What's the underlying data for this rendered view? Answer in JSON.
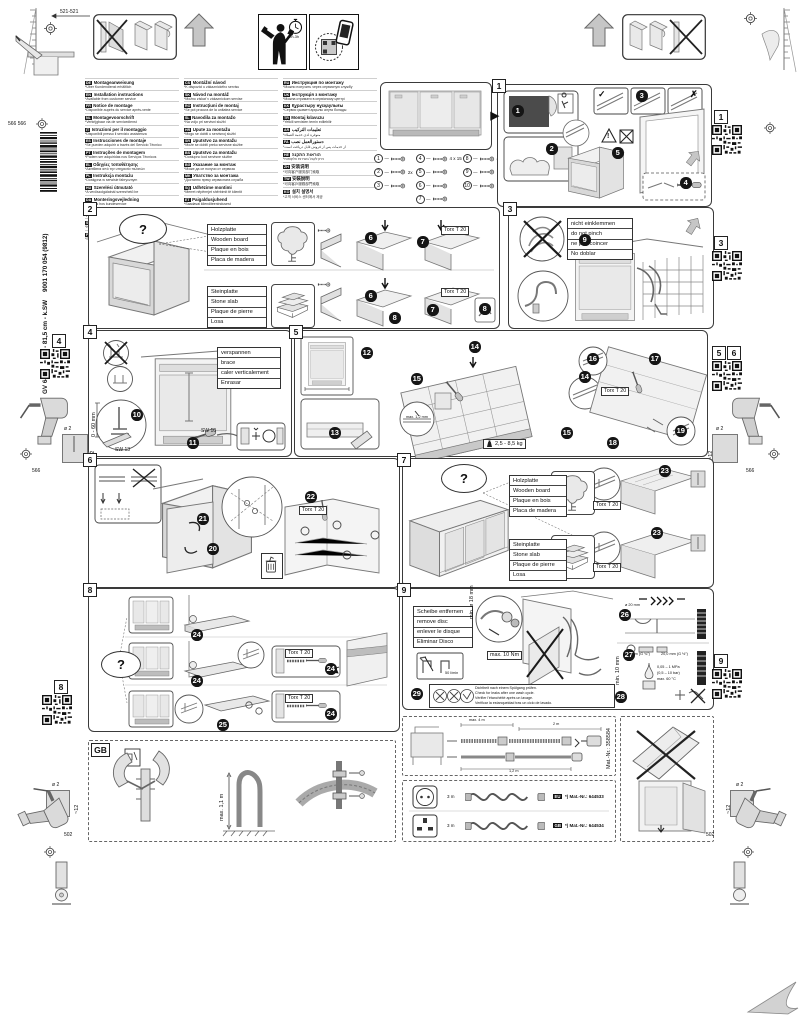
{
  "page": {
    "d521": "521-521",
    "d566566": "566 566",
    "d566": "566",
    "d502": "502",
    "dia2": "ø 2",
    "d12": "~12",
    "barcode_text": "9001 170 054 (9812)",
    "product_text": "GV 640 B VolI-I - 81,5 cm - k.SW",
    "time": "~2h-3h"
  },
  "labels": {
    "torx": "Torx T 20",
    "q": "?",
    "check": "✓",
    "cross": "✗",
    "warn": "!"
  },
  "steps": {
    "1": "1",
    "2": "2",
    "3": "3",
    "4": "4",
    "5": "5",
    "6": "6",
    "7": "7",
    "8": "8",
    "9": "9",
    "10": "10",
    "11": "11",
    "12": "12",
    "13": "13",
    "14": "14",
    "15": "15",
    "16": "16",
    "17": "17",
    "18": "18",
    "19": "19",
    "20": "20",
    "21": "21",
    "22": "22",
    "23": "23",
    "24": "24",
    "25": "25",
    "26": "26",
    "27": "27",
    "28": "28",
    "29": "29"
  },
  "qr_labels": {
    "q1": "1",
    "q3": "3",
    "q4": "4",
    "q5": "5",
    "q6": "6",
    "q8": "8",
    "q9": "9",
    "gb": "GB"
  },
  "langs": {
    "col1": [
      {
        "code": "de",
        "title": "Montageanweisung",
        "note": "*Über Kundendienst erhältlich"
      },
      {
        "code": "en",
        "title": "Installation instructions",
        "note": "*Available from customer service"
      },
      {
        "code": "fr",
        "title": "Notice de montage",
        "note": "*Disponible auprès du service après-vente"
      },
      {
        "code": "nl",
        "title": "Montagevoorschrift",
        "note": "*Verkrijgbaar via de servicedienst"
      },
      {
        "code": "it",
        "title": "Istruzioni per il montaggio",
        "note": "*Disponibili presso il servizio assistenza"
      },
      {
        "code": "es",
        "title": "Instrucciones de montaje",
        "note": "*Se pueden adquirir a través del Servicio Técnico"
      },
      {
        "code": "pt",
        "title": "Instruções de montagem",
        "note": "*Podem ser adquiridas nos Serviços Técnicos"
      },
      {
        "code": "el",
        "title": "Οδηγίες τοποθέτησης",
        "note": "*Διατίθεται από την υπηρεσία πελατών"
      },
      {
        "code": "pl",
        "title": "Instrukcja montażu",
        "note": "*Dostępna w serwisie fabrycznym"
      },
      {
        "code": "hu",
        "title": "Szerelési útmutató",
        "note": "*A vevőszolgálatnál szerezhető be"
      },
      {
        "code": "da",
        "title": "Monteringsvejledning",
        "note": "*Kan fås hos kundeservice"
      },
      {
        "code": "no",
        "title": "Monteringsanvisning",
        "note": "*Fås hos kundeservice"
      },
      {
        "code": "sv",
        "title": "Monteringsanvisning",
        "note": "*Kan beställas hos kundtjänst"
      },
      {
        "code": "fi",
        "title": "Asennusohje",
        "note": "*Saatavana huoltopalvelusta"
      }
    ],
    "col2": [
      {
        "code": "cs",
        "title": "Montážní návod",
        "note": "*K dispozici u zákaznického servisu"
      },
      {
        "code": "sk",
        "title": "Návod na montáž",
        "note": "*Možno získať v zákazníckom servise"
      },
      {
        "code": "ro",
        "title": "Instrucţiuni de montaj",
        "note": "*Se pot procura de la unitatea service"
      },
      {
        "code": "sl",
        "title": "Navodila za montažo",
        "note": "*Na voljo pri servisni službi"
      },
      {
        "code": "hr",
        "title": "Upute za montažu",
        "note": "*Mogu se dobiti u servisnoj službi"
      },
      {
        "code": "sr",
        "title": "Uputstvo za montažu",
        "note": "*Može se dobiti preko servisne službe"
      },
      {
        "code": "bs",
        "title": "Uputstvo za montažu",
        "note": "*Dostupno kod servisne službe"
      },
      {
        "code": "bg",
        "title": "Указание за монтаж",
        "note": "*Може да се получи от сервиза"
      },
      {
        "code": "mk",
        "title": "Упатство за монтажа",
        "note": "*Достапно преку сервисната служба"
      },
      {
        "code": "sq",
        "title": "Udhëzime montimi",
        "note": "*Merret nëpërmjet shërbimit të klientit"
      },
      {
        "code": "et",
        "title": "Paigaldusjuhend",
        "note": "*Saadaval klienditeenindusest"
      },
      {
        "code": "lv",
        "title": "Montāžas instrukcija",
        "note": "*Saņemama klientu servisā"
      },
      {
        "code": "lt",
        "title": "Montavimo instrukcija",
        "note": "*Gaunama iš klientų aptarnavimo tarnybos"
      }
    ],
    "col3": [
      {
        "code": "ru",
        "title": "Инструкция по монтажу",
        "note": "*Можно получить через сервисную службу"
      },
      {
        "code": "uk",
        "title": "Інструкція з монтажу",
        "note": "*Можна отримати в сервісному центрі"
      },
      {
        "code": "kk",
        "title": "Құрастыру нұсқаулығы",
        "note": "*Сервис қызметі арқылы алуға болады"
      },
      {
        "code": "tr",
        "title": "Montaj kılavuzu",
        "note": "*Yetkili servisten temin edilebilir"
      },
      {
        "code": "ar",
        "title": "تعليمات التركيب",
        "note": "*متوفرة لدى خدمة العملاء"
      },
      {
        "code": "fa",
        "title": "دستورالعمل نصب",
        "note": "*از خدمات پس از فروش قابل دریافت است"
      },
      {
        "code": "he",
        "title": "הוראות התקנה",
        "note": "*ניתן לקבל בשירות הלקוחות"
      },
      {
        "code": "zh",
        "title": "安装说明",
        "note": "*可向客户服务部门索取"
      },
      {
        "code": "tw",
        "title": "安裝說明",
        "note": "*可向客戶服務部門索取"
      },
      {
        "code": "ko",
        "title": "설치 설명서",
        "note": "*고객 서비스 센터에서 제공"
      }
    ]
  },
  "parts": {
    "colA": [
      {
        "n": "1",
        "spec": ""
      },
      {
        "n": "2",
        "spec": "2x"
      },
      {
        "n": "3",
        "spec": ""
      }
    ],
    "colB": [
      {
        "n": "4",
        "spec": "4 x 15"
      },
      {
        "n": "5",
        "spec": ""
      },
      {
        "n": "6",
        "spec": ""
      },
      {
        "n": "7",
        "spec": ""
      }
    ],
    "colC": [
      {
        "n": "8",
        "spec": "4 x 15"
      },
      {
        "n": "9",
        "spec": ""
      },
      {
        "n": "10",
        "spec": ""
      }
    ]
  },
  "panel2": {
    "wood": [
      "Holzplatte",
      "Wooden board",
      "Plaque en bois",
      "Placa de madera"
    ],
    "stone": [
      "Steinplatte",
      "Stone slab",
      "Plaque de pierre",
      "Losa"
    ]
  },
  "panel3": {
    "pinch": [
      "nicht einklemmen",
      "do not pinch",
      "ne pas coincer",
      "No doblar"
    ]
  },
  "panel4": {
    "brace": [
      "verspannen",
      "brace",
      "caler verticalement",
      "Enrasar"
    ],
    "sw13": "SW 13",
    "sw10": "SW 10",
    "range": "0 - 60 mm"
  },
  "panel5": {
    "gap": "max. 1,2 mm",
    "weight": "2,5 - 8,5 kg"
  },
  "panel9": {
    "disc": [
      "Scheibe entfernen",
      "remove disc",
      "enlever le disque",
      "Eliminar Disco"
    ],
    "torque": "max. 10 Nm",
    "dia18": "min. ø 18 mm",
    "dia20": "ø 20 mm",
    "flow": "50 l/min",
    "thread_a": "26,4 mm (G ¾\")",
    "thread_b": "20,0 mm (G ½\")",
    "min10": "min. 10 mm",
    "pressure": "0,05 – 1 MPa",
    "pressure2": "(0,5 – 10 bar)",
    "temp": "max. 60 °C",
    "leak": [
      "Dichtheit nach einem Spülgang prüfen.",
      "Check for leaks after one wash cycle.",
      "Vérifier l'étanchéité après un lavage.",
      "Verificar la estanqueidad tras un ciclo de lavado."
    ]
  },
  "hose_ext": {
    "d_max": "max. 4 m",
    "d2": "2 m",
    "d12": "1,2 m",
    "mat": "Mat.-Nr.: 358584"
  },
  "power": {
    "rows": [
      {
        "len": "3 m",
        "tag": "EU",
        "mat": "*) Mat.-Nr.: 644533"
      },
      {
        "len": "3 m",
        "tag": "GB",
        "mat": "*) Mat.-Nr.: 644534"
      }
    ]
  },
  "gb": {
    "height": "max. 1,1 m"
  }
}
